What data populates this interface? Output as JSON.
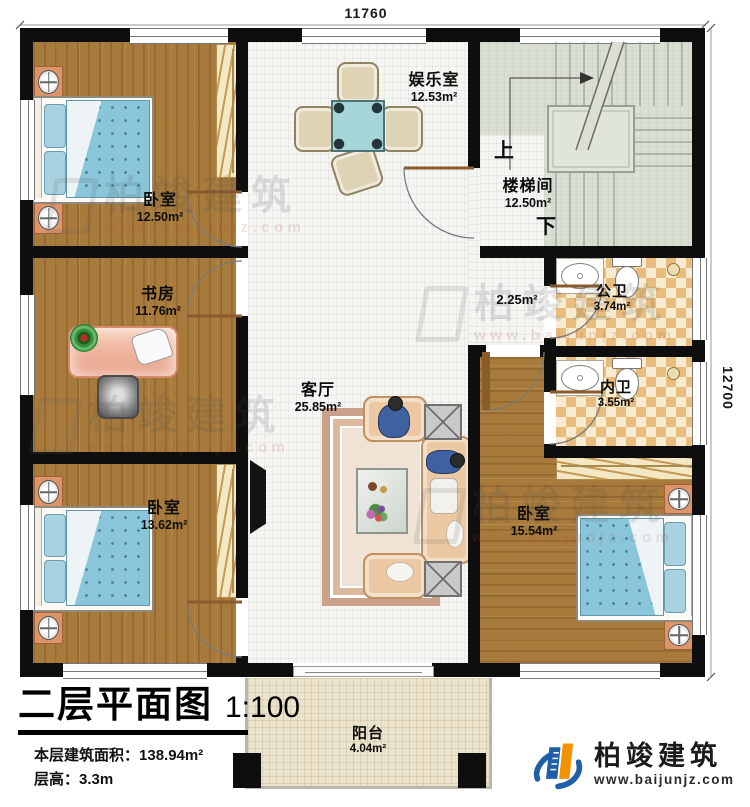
{
  "colors": {
    "wall": "#0e0e0e",
    "wood-floor": "#a87b3d",
    "tile-floor": "#f5f5f2",
    "stair-floor": "#d9dfd3",
    "bath-tile": "#e8bc7d",
    "balcony-floor": "#ece3cd",
    "bed-blue": "#89c6da",
    "sofa-peach": "#ecc9a2",
    "brand-blue": "#1e5fa8",
    "brand-orange": "#f39200"
  },
  "dimensions": {
    "top": "11760",
    "right": "12700"
  },
  "rooms": {
    "bedroom_tl": {
      "name": "卧室",
      "area": "12.50m²"
    },
    "study": {
      "name": "书房",
      "area": "11.76m²"
    },
    "bedroom_bl": {
      "name": "卧室",
      "area": "13.62m²"
    },
    "entertainment": {
      "name": "娱乐室",
      "area": "12.53m²"
    },
    "living": {
      "name": "客厅",
      "area": "25.85m²"
    },
    "stairwell": {
      "name": "楼梯间",
      "area": "12.50m²"
    },
    "bath_public": {
      "name": "公卫",
      "area": "3.74m²"
    },
    "bath_private": {
      "name": "内卫",
      "area": "3.55m²"
    },
    "bedroom_br": {
      "name": "卧室",
      "area": "15.54m²"
    },
    "balcony": {
      "name": "阳台",
      "area": "4.04m²"
    }
  },
  "hall": {
    "area": "2.25m²"
  },
  "stairs": {
    "up": "上",
    "down": "下"
  },
  "titleblock": {
    "title": "二层平面图",
    "scale": "1:100",
    "area_label": "本层建筑面积：",
    "area_value": "138.94m²",
    "height_label": "层高：",
    "height_value": "3.3m"
  },
  "brand": {
    "name": "柏竣建筑",
    "site": "www.baijunjz.com"
  },
  "watermark": {
    "name": "柏竣建筑",
    "site": "www.baijunjz.com"
  }
}
